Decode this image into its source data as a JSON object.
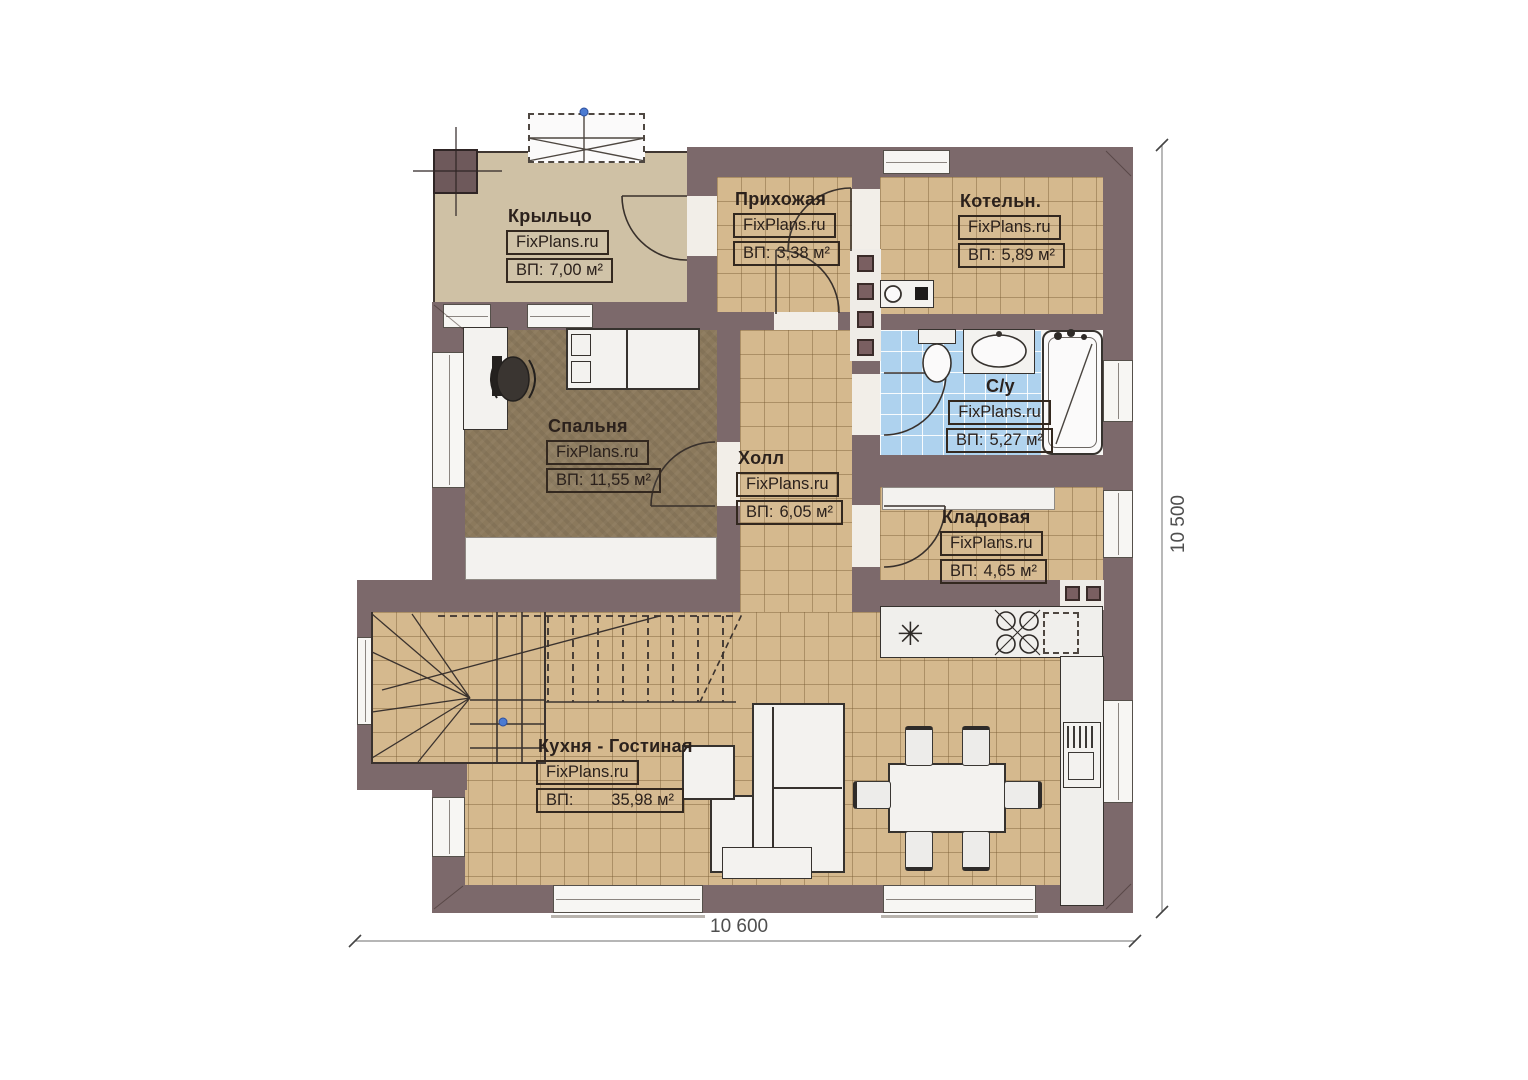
{
  "title": "План 1 этажа",
  "dimensions": {
    "bottom": "10 600",
    "right": "10 500"
  },
  "icons": {
    "sink": "✳"
  },
  "rooms": {
    "porch": {
      "name": "Крыльцо",
      "brand": "FixPlans.ru",
      "area_label": "ВП:",
      "area_value": "7,00 м²"
    },
    "entry": {
      "name": "Прихожая",
      "brand": "FixPlans.ru",
      "area_label": "ВП:",
      "area_value": "3,38 м²"
    },
    "boiler": {
      "name": "Котельн.",
      "brand": "FixPlans.ru",
      "area_label": "ВП:",
      "area_value": "5,89 м²"
    },
    "bathroom": {
      "name": "С/у",
      "brand": "FixPlans.ru",
      "area_label": "ВП:",
      "area_value": "5,27 м²"
    },
    "bedroom": {
      "name": "Спальня",
      "brand": "FixPlans.ru",
      "area_label": "ВП:",
      "area_value": "11,55 м²"
    },
    "hall": {
      "name": "Холл",
      "brand": "FixPlans.ru",
      "area_label": "ВП:",
      "area_value": "6,05 м²"
    },
    "storage": {
      "name": "Кладовая",
      "brand": "FixPlans.ru",
      "area_label": "ВП:",
      "area_value": "4,65 м²"
    },
    "kitchen": {
      "name": "Кухня - Гостиная",
      "brand": "FixPlans.ru",
      "area_label": "ВП:",
      "area_value": "35,98 м²"
    }
  },
  "colors": {
    "wall": "#7c696b",
    "tile": "#d5b98e",
    "bathTile": "#aed2ee",
    "bedroomFloor": "#8b795c",
    "porchFloor": "#cfc1a5",
    "accentDot": "#4c7bd2"
  }
}
